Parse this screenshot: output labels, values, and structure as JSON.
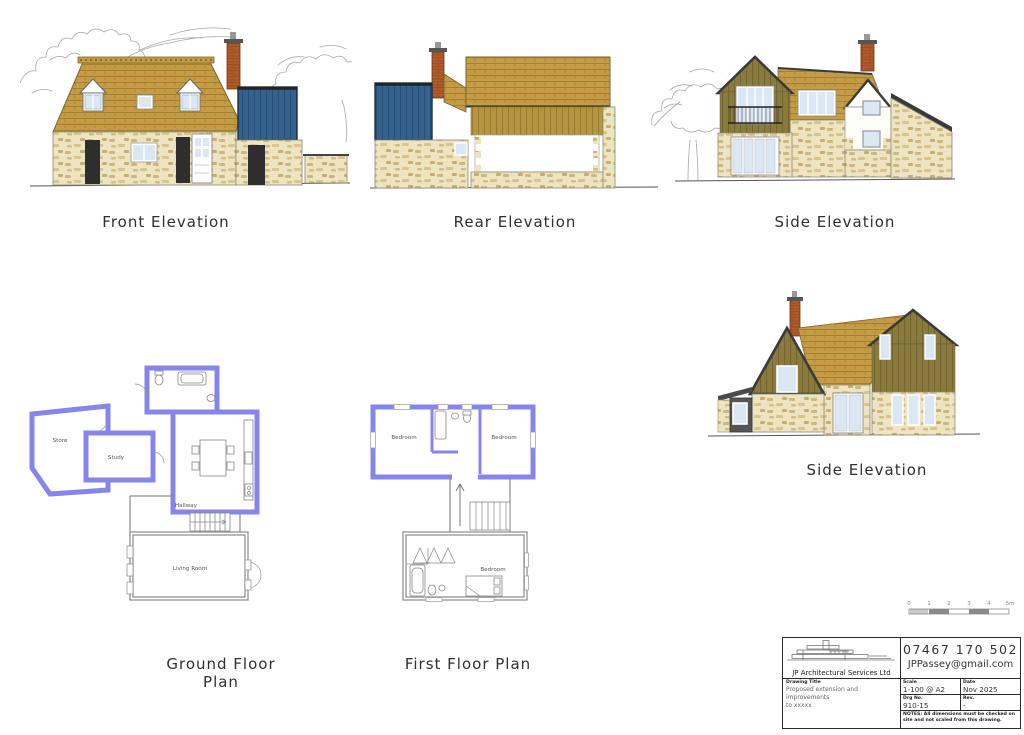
{
  "sheet": {
    "captions": {
      "front": "Front Elevation",
      "rear": "Rear Elevation",
      "side_top": "Side Elevation",
      "side_mid": "Side Elevation",
      "ground": "Ground Floor Plan",
      "first": "First Floor Plan"
    }
  },
  "ground_floor": {
    "store": "Store",
    "study": "Study",
    "hallway": "Hallway",
    "living_room": "Living Room"
  },
  "first_floor": {
    "bedroom_left": "Bedroom",
    "bedroom_right": "Bedroom",
    "bedroom_rear": "Bedroom"
  },
  "scale_bar": {
    "t0": "0",
    "t1": "1",
    "t2": "2",
    "t3": "3",
    "t4": "4",
    "t5": "5m"
  },
  "title_block": {
    "company": "JP Architectural Services Ltd",
    "phone": "07467 170 502",
    "email": "JPPassey@gmail.com",
    "drawing_title_label": "Drawing Title",
    "drawing_title_line1": "Proposed extension and improvements",
    "drawing_title_line2": "to xxxxx",
    "scale_label": "Scale",
    "scale_value": "1-100 @ A2",
    "date_label": "Date",
    "date_value": "Nov 2025",
    "drg_label": "Drg No.",
    "drg_value": "910-15",
    "rev_label": "Rev.",
    "rev_value": "-",
    "notes_label": "NOTES:",
    "notes_text": "All dimensions must be checked on site and not scaled from this drawing."
  },
  "colors": {
    "roof_tile": "#c59c45",
    "timber_tan": "#b5953f",
    "timber_olive": "#8a7b3d",
    "cladding_blue": "#33628f",
    "stone": "#ede4c2",
    "brick": "#b15a2a",
    "proposed_wall_purple": "#8585ec",
    "glass": "#dbe8f4",
    "sketch_grey": "#a8a8a8"
  }
}
